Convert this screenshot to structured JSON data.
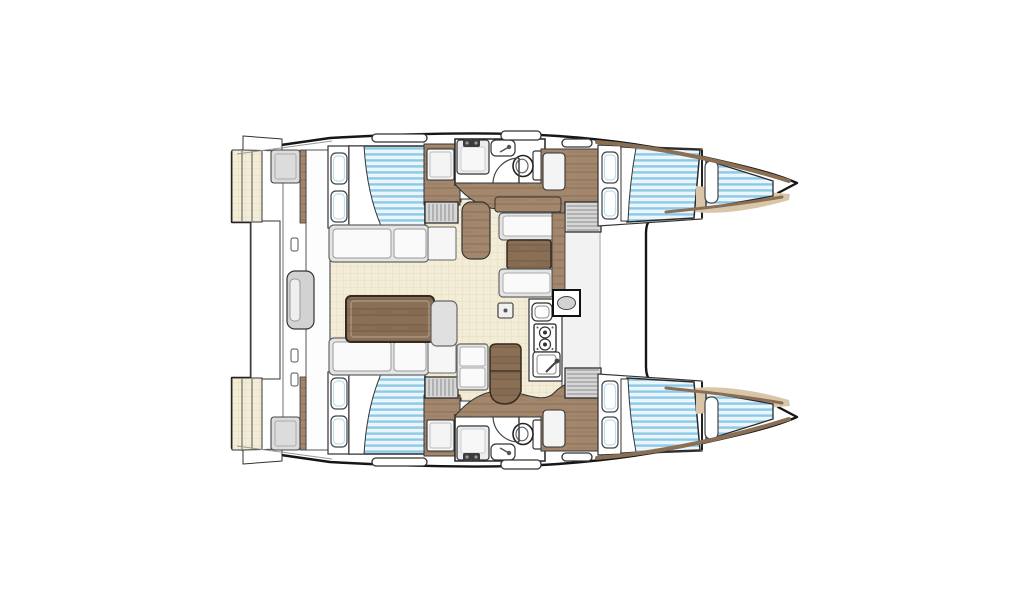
{
  "meta": {
    "title": "Catamaran interior floor plan — top-down layout diagram",
    "view": "top-down",
    "orientation": "bow-right"
  },
  "colors": {
    "outline": "#161616",
    "duvet_light": "#eaf6fc",
    "duvet_stripe": "#8ec9e8",
    "deck_cream": "#f3edd8",
    "deck_cream_line": "#e5dcbe",
    "wood": "#a3876c",
    "wood_streak": "#8f735a",
    "wood_dark": "#8a6f55",
    "wood_dark_streak": "#755d47",
    "floor_tan": "#d9c6a9",
    "furniture_gray": "#e4e4e4",
    "cushion_white": "#fafafa",
    "steps_gray": "#d7d7d7",
    "fixture_white": "#ffffff",
    "hardware_dark": "#3c3c3c",
    "wall_band": "#f2f2f2",
    "rail_brown": "#8a6f55",
    "bg": "#ffffff"
  },
  "features": [
    "port-aft-double-cabin",
    "port-forward-double-cabin",
    "port-bow-vberth",
    "starboard-aft-double-cabin",
    "starboard-forward-double-cabin",
    "starboard-bow-vberth",
    "port-head-with-toilet-and-sinks",
    "starboard-head-with-toilet-and-sinks",
    "saloon-u-sofa-with-table",
    "dinette-with-table",
    "galley-with-stove-and-sinks",
    "companionway-steps",
    "cockpit-with-sliding-door",
    "twin-transom-swim-steps",
    "deck-hatches",
    "bow-toe-rails"
  ]
}
